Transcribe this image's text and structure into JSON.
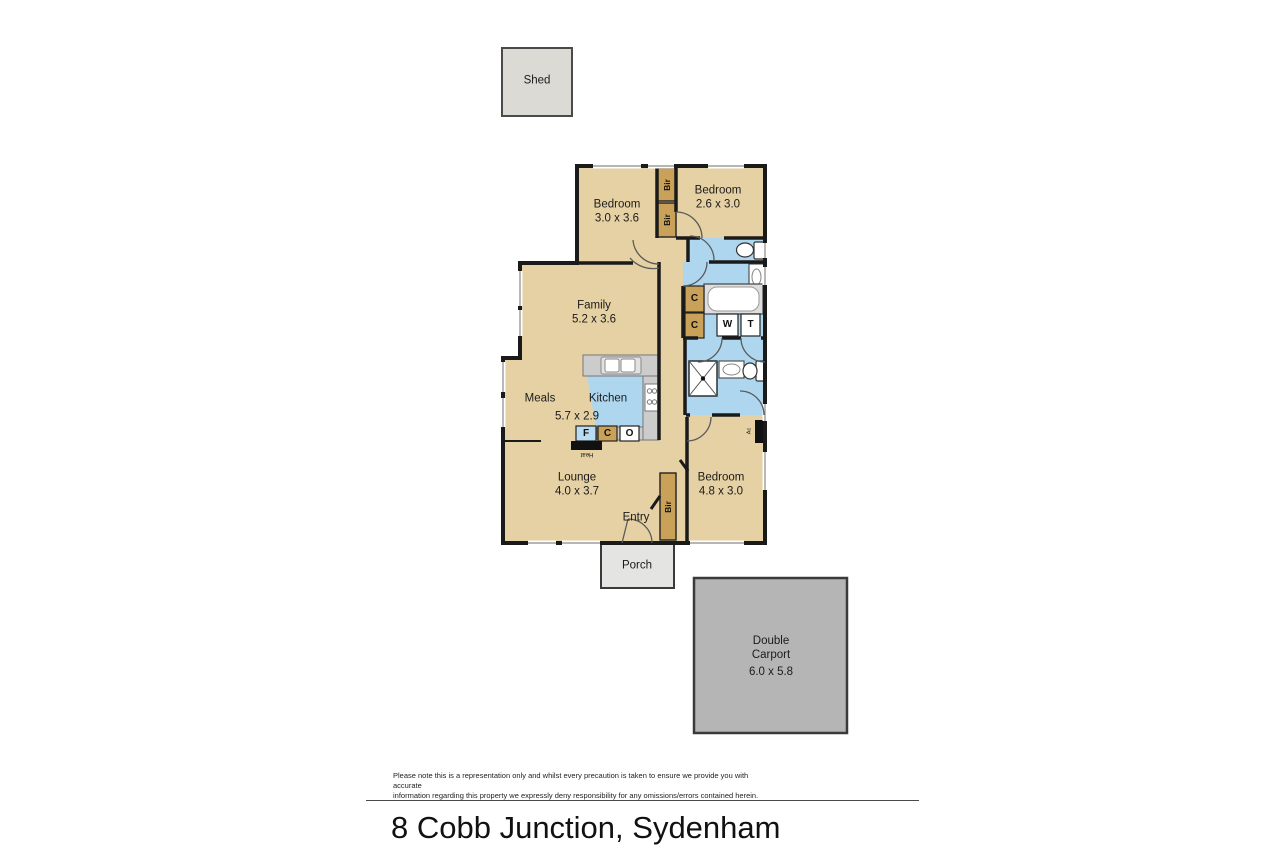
{
  "colors": {
    "floor_tan": "#e5d1a3",
    "wet_blue": "#aed6ee",
    "robe_tan": "#c9a159",
    "wall": "#1a1a1a",
    "shed_gray": "#dcdad5",
    "porch_gray": "#e4e4e2",
    "carport_gray": "#b5b5b5",
    "bench_gray": "#cccccc"
  },
  "plan": {
    "shed": {
      "label": "Shed"
    },
    "rooms": {
      "bedroom1": {
        "name": "Bedroom",
        "dims": "3.0 x 3.6"
      },
      "bedroom2": {
        "name": "Bedroom",
        "dims": "2.6 x 3.0"
      },
      "family": {
        "name": "Family",
        "dims": "5.2 x 3.6"
      },
      "meals": {
        "name": "Meals"
      },
      "kitchen": {
        "name": "Kitchen",
        "dims": "5.7 x 2.9"
      },
      "lounge": {
        "name": "Lounge",
        "dims": "4.0 x 3.7"
      },
      "entry": {
        "name": "Entry"
      },
      "bedroom3": {
        "name": "Bedroom",
        "dims": "4.8 x 3.0"
      },
      "porch": {
        "name": "Porch"
      }
    },
    "carport": {
      "line1": "Double",
      "line2": "Carport",
      "dims": "6.0 x 5.8"
    },
    "fixtures": {
      "robe": "Bir",
      "cupboard": "C",
      "fridge": "F",
      "oven": "O",
      "washer": "W",
      "trough": "T",
      "heater": "Heat",
      "aircon": "Ac"
    }
  },
  "footer": {
    "disclaimer_line1": "Please note this is a representation only and whilst every precaution is taken to ensure we provide you with accurate",
    "disclaimer_line2": "information regarding this property we expressly deny responsibility for any omissions/errors contained herein.",
    "title": "8 Cobb Junction, Sydenham"
  }
}
